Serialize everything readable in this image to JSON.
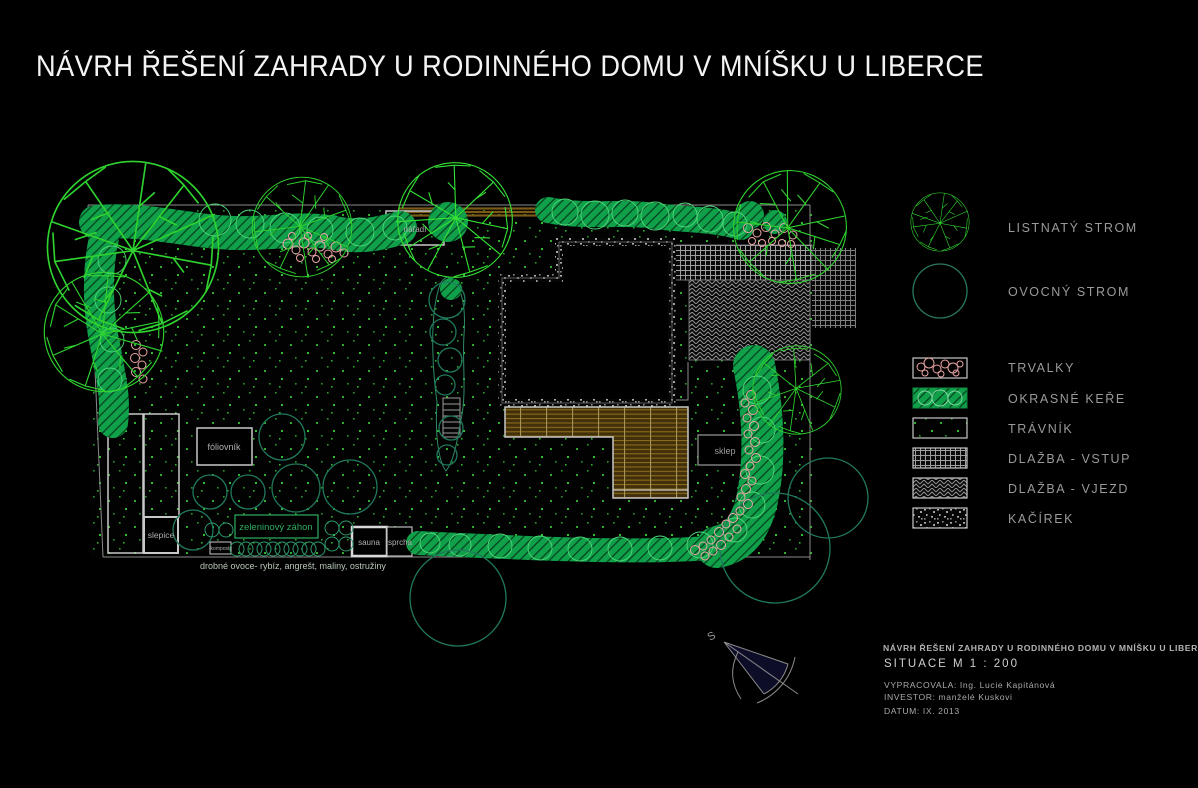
{
  "title": "NÁVRH ŘEŠENÍ ZAHRADY U RODINNÉHO DOMU V MNÍŠKU U LIBERCE",
  "plan": {
    "labels": {
      "naradi": "nářadí",
      "foliovnik": "fóliovník",
      "slepice": "slepice",
      "kompost": "kompost",
      "zeleninovy_zahon": "zeleninový záhon",
      "sauna": "sauna",
      "sprcha": "sprcha",
      "sklep": "sklep",
      "drobne_ovoce": "drobné ovoce- rybíz, angrešt, maliny, ostružiny"
    },
    "north_label": "S"
  },
  "legend": {
    "items": [
      {
        "id": "deciduous-tree",
        "label": "LISTNATÝ STROM"
      },
      {
        "id": "fruit-tree",
        "label": "OVOCNÝ STROM"
      },
      {
        "id": "perennials",
        "label": "TRVALKY"
      },
      {
        "id": "ornamental-shrubs",
        "label": "OKRASNÉ KEŘE"
      },
      {
        "id": "lawn",
        "label": "TRÁVNÍK"
      },
      {
        "id": "paving-entrance",
        "label": "DLAŽBA - VSTUP"
      },
      {
        "id": "paving-driveway",
        "label": "DLAŽBA - VJEZD"
      },
      {
        "id": "pebble-gravel",
        "label": "KAČÍREK"
      }
    ]
  },
  "title_block": {
    "project": "NÁVRH ŘEŠENÍ ZAHRADY U RODINNÉHO DOMU V MNÍŠKU U LIBERCE",
    "drawing": "SITUACE  M 1 : 200",
    "author": "VYPRACOVALA: Ing. Lucie Kapitánová",
    "investor": "INVESTOR: manželé Kuskovi",
    "date": "DATUM: IX. 2013"
  },
  "colors": {
    "background": "#000000",
    "title_text": "#f4f4f4",
    "legend_text": "#9a9a9a",
    "tree_green": "#2fd32f",
    "shrub_green": "#11a04a",
    "fruit_tree_teal": "#20795c",
    "perennial_pink": "#eca6a6",
    "paving_gray": "#9c9c9c",
    "deck_brown": "#8a6a1e",
    "lawn_dot_green": "#39b539"
  }
}
